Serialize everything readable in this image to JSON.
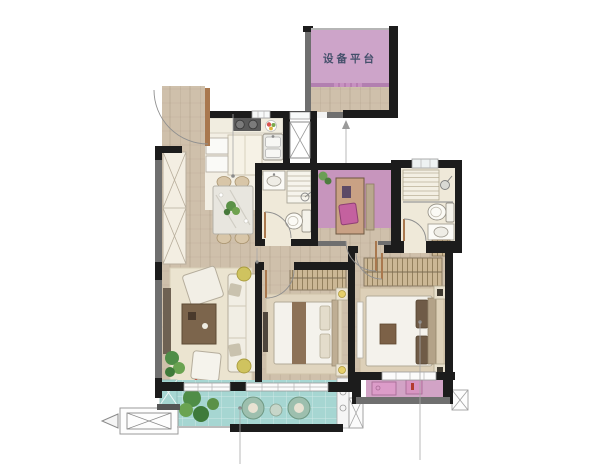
{
  "floor_plan": {
    "labels": {
      "equipment_platform": "设备平台"
    },
    "colors": {
      "wall_black": "#1c1c1c",
      "wall_gray": "#6f6f6f",
      "wood": "#cfc0ab",
      "kitchen_floor": "#f3efe4",
      "bath_floor": "#efe9d9",
      "platform_pink": "#cda4c9",
      "study_pink": "#c795bd",
      "balcony_pink": "#d2a3c6",
      "balcony_teal": "#a6d6d2",
      "rug_living": "#ebe4d0",
      "rug_bedroom": "#ddd0b8",
      "furniture_white": "#f4f2ec",
      "furniture_brown": "#7c654c",
      "accent_yellow": "#e7d06b",
      "plant_green": "#5b9147",
      "leader_gray": "#9a9a9a",
      "label_text": "#44506b",
      "door_wood": "#a9784e"
    }
  }
}
